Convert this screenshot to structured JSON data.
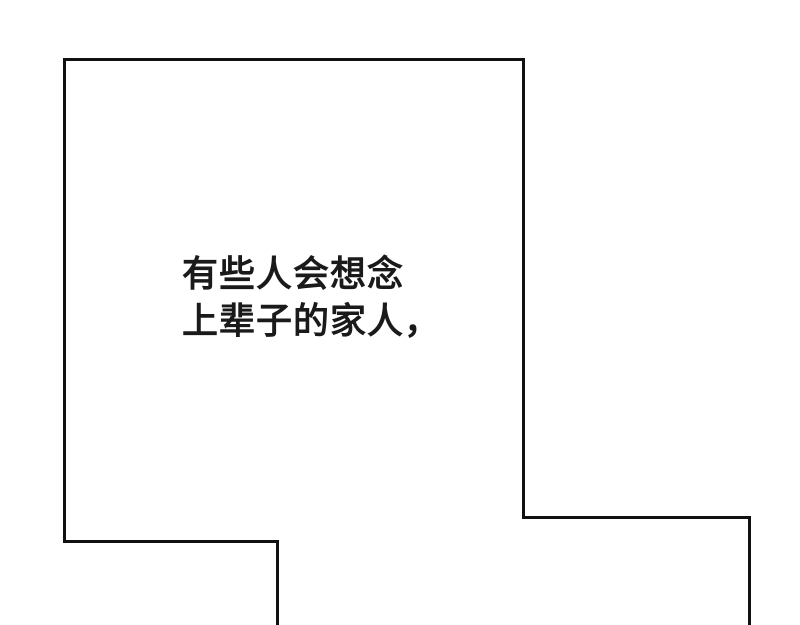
{
  "page": {
    "background_color": "#ffffff",
    "panel_border_color": "#111111"
  },
  "panel": {
    "narration": {
      "lines": [
        "有些人会想念",
        "上辈子的家人，"
      ],
      "text_color": "#1a1a1a"
    }
  }
}
